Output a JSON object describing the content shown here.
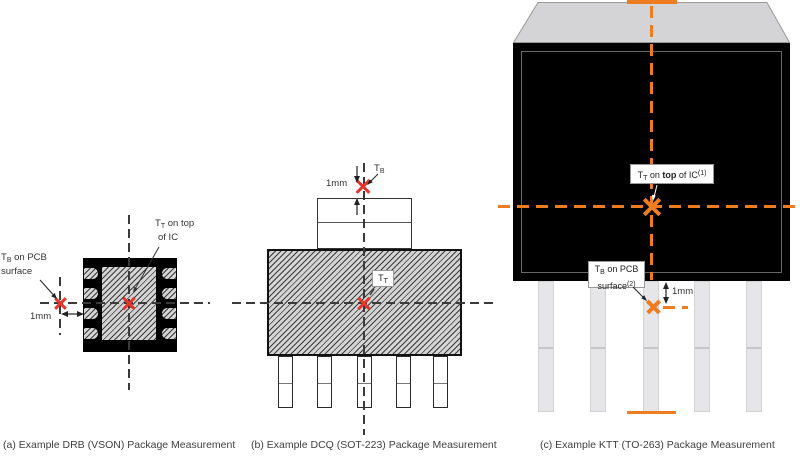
{
  "colors": {
    "accent_orange": "#EE7D22",
    "marker_red": "#E2352B"
  },
  "captions": {
    "a": "(a) Example DRB (VSON) Package Measurement",
    "b": "(b) Example DCQ (SOT-223) Package Measurement",
    "c": "(c) Example KTT (TO-263) Package Measurement"
  },
  "fig_a": {
    "tb_label": {
      "sym": "T",
      "sub": "B",
      "rest": " on PCB",
      "line2": "surface"
    },
    "tt_label": {
      "sym": "T",
      "sub": "T",
      "rest": " on top",
      "line2": "of IC"
    },
    "dim": "1mm"
  },
  "fig_b": {
    "tb_label": {
      "sym": "T",
      "sub": "B"
    },
    "tt_label": {
      "sym": "T",
      "sub": "T"
    },
    "dim": "1mm"
  },
  "fig_c": {
    "tt_label": {
      "sym": "T",
      "sub": "T",
      "mid": " on ",
      "bold": "top",
      "rest": " of IC",
      "sup": "(1)"
    },
    "tb_label": {
      "sym": "T",
      "sub": "B",
      "rest": " on PCB",
      "line2": "surface",
      "sup": "(2)"
    },
    "dim": "1mm"
  }
}
